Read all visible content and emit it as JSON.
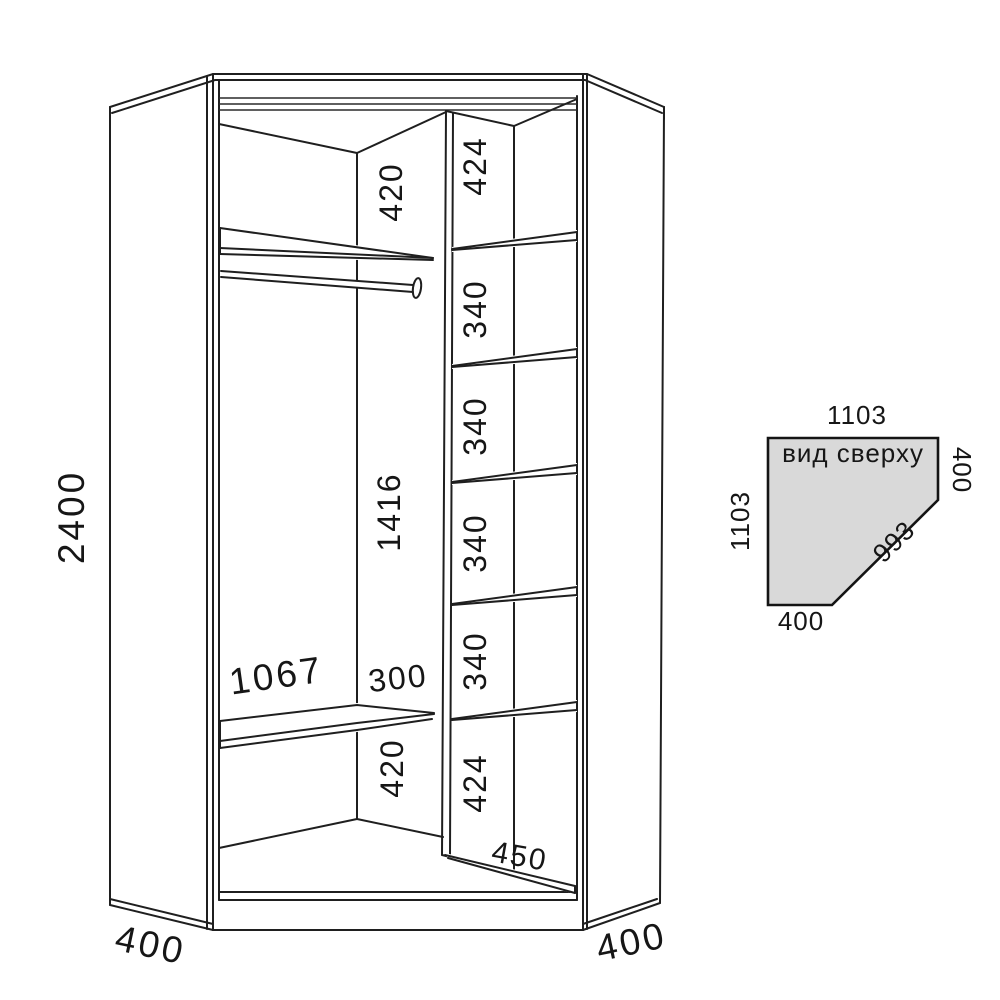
{
  "front_view": {
    "overall_height": "2400",
    "side_depth_left": "400",
    "side_depth_right": "400",
    "top_gap": "420",
    "rod_section_height": "1416",
    "bottom_gap": "420",
    "shelf_width": "1067",
    "shelf_offset": "300",
    "column_floor_depth": "450",
    "column_sections": [
      "424",
      "340",
      "340",
      "340",
      "340",
      "424"
    ]
  },
  "top_view": {
    "caption": "вид сверху",
    "top_width": "1103",
    "left_depth": "1103",
    "right_side": "400",
    "bottom_side": "400",
    "front_diagonal": "993"
  }
}
